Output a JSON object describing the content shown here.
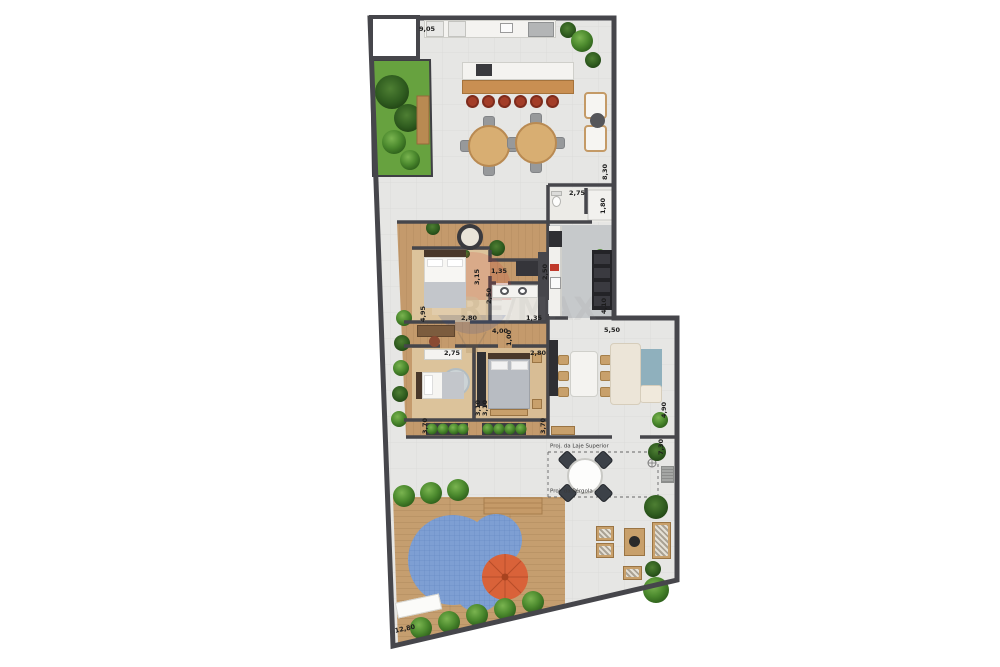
{
  "watermark": {
    "brand": "RE/MAX"
  },
  "floor_plan": {
    "dimensions": [
      {
        "label": "9,05",
        "x": 427,
        "y": 29,
        "rot": 0
      },
      {
        "label": "8,30",
        "x": 605,
        "y": 172,
        "rot": -90
      },
      {
        "label": "2,75",
        "x": 577,
        "y": 193,
        "rot": 0
      },
      {
        "label": "1,80",
        "x": 603,
        "y": 206,
        "rot": -90
      },
      {
        "label": "2,50",
        "x": 545,
        "y": 272,
        "rot": -90
      },
      {
        "label": "4,10",
        "x": 604,
        "y": 306,
        "rot": -90
      },
      {
        "label": "3,15",
        "x": 477,
        "y": 277,
        "rot": -90
      },
      {
        "label": "1,35",
        "x": 499,
        "y": 271,
        "rot": 0
      },
      {
        "label": "2,50",
        "x": 489,
        "y": 296,
        "rot": -90
      },
      {
        "label": "1,35",
        "x": 534,
        "y": 318,
        "rot": 0
      },
      {
        "label": "2,80",
        "x": 469,
        "y": 318,
        "rot": 0
      },
      {
        "label": "4,95",
        "x": 423,
        "y": 314,
        "rot": -90
      },
      {
        "label": "4,00",
        "x": 500,
        "y": 331,
        "rot": 0
      },
      {
        "label": "1,00",
        "x": 509,
        "y": 338,
        "rot": -90
      },
      {
        "label": "2,75",
        "x": 452,
        "y": 353,
        "rot": 0
      },
      {
        "label": "2,80",
        "x": 538,
        "y": 353,
        "rot": 0
      },
      {
        "label": "3,10",
        "x": 478,
        "y": 408,
        "rot": -90
      },
      {
        "label": "3,10",
        "x": 485,
        "y": 408,
        "rot": -90
      },
      {
        "label": "3,70",
        "x": 425,
        "y": 426,
        "rot": -90
      },
      {
        "label": "3,70",
        "x": 543,
        "y": 426,
        "rot": -90
      },
      {
        "label": "5,50",
        "x": 612,
        "y": 330,
        "rot": 0
      },
      {
        "label": "4,90",
        "x": 664,
        "y": 410,
        "rot": -90
      },
      {
        "label": "7,30",
        "x": 661,
        "y": 447,
        "rot": -90
      },
      {
        "label": "12,80",
        "x": 405,
        "y": 629,
        "rot": -12
      }
    ],
    "annotations": [
      {
        "label": "Proj. da Laje Superior",
        "x": 550,
        "y": 447
      },
      {
        "label": "Proj. da Pérgola",
        "x": 550,
        "y": 492
      }
    ],
    "colors": {
      "wall": "#46464b",
      "terrace_floor": "#e6e6e4",
      "wood_deck": "#c59e6f",
      "bedroom_floor": "#dcc39b",
      "kitchen_floor": "#c6c9cb",
      "garden_green": "#67a23f",
      "pool_blue": "#7e9fd3",
      "umbrella_orange": "#d96239",
      "stool_red": "#a33d28",
      "furniture_wood": "#c8a06b",
      "sofa_cream": "#ece5d8",
      "rug_blue": "#8fb0bd"
    }
  }
}
